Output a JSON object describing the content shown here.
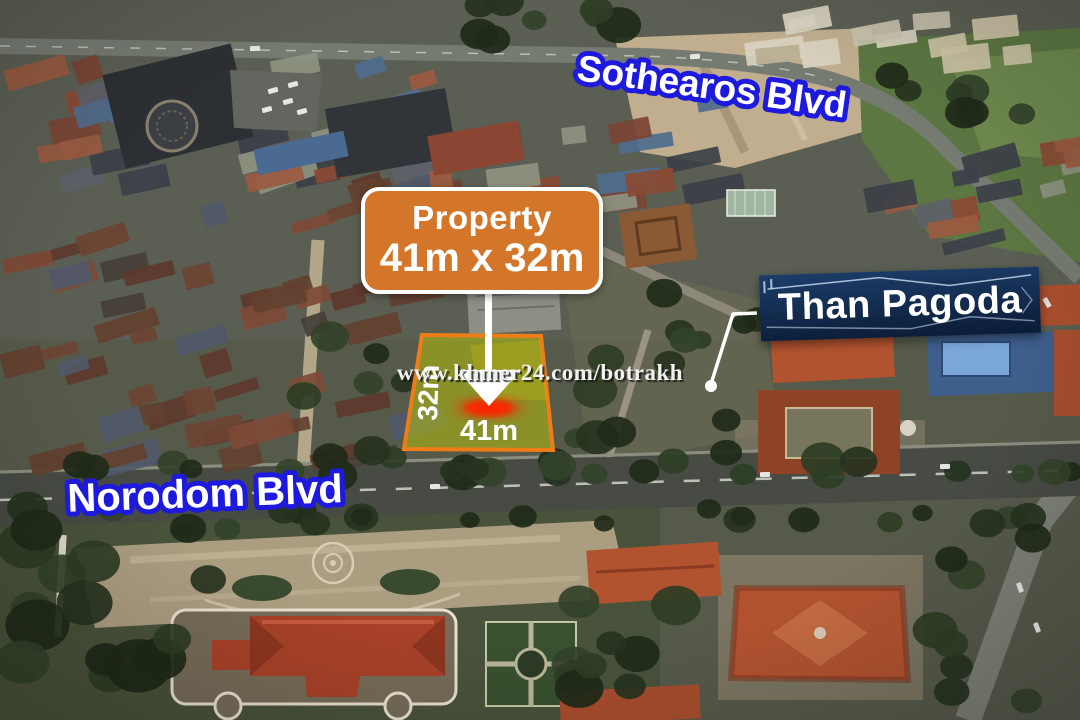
{
  "watermark": "www.khmer24.com/botrakh",
  "streets": {
    "top": "Sothearos Blvd",
    "bottom": "Norodom Blvd"
  },
  "landmark": {
    "name": "Than Pagoda"
  },
  "property": {
    "callout_title": "Property",
    "callout_size": "41m x 32m",
    "width_label": "41m",
    "depth_label": "32m"
  },
  "colors": {
    "callout_bg": "#d4762a",
    "street_label_fill": "#ffffff",
    "street_label_outline": "#1d19dd",
    "landmark_bg": "#12294a",
    "plot_fill": "#c9d400",
    "plot_border": "#ee7d18",
    "marker_red": "#ff2000",
    "arrow_white": "#ffffff"
  }
}
